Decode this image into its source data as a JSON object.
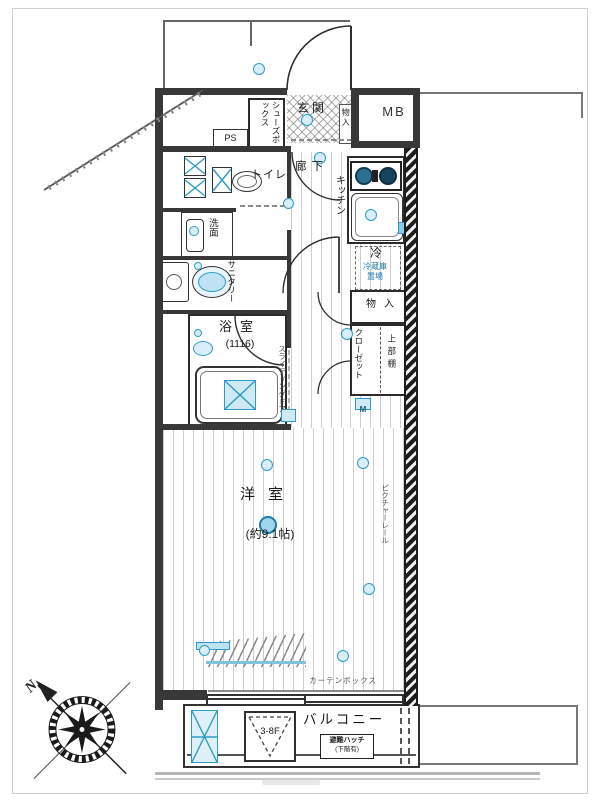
{
  "meta": {
    "accent_blue": "#2e9bc6",
    "fill_blue": "#d8eef8",
    "text_blue": "#1f78a8",
    "wall_color": "#383838"
  },
  "exterior": {
    "mb": "MB",
    "north": "N"
  },
  "entrance": {
    "genkan": "玄関",
    "shoes_box": "シューズボックス",
    "ps": "PS",
    "storage": "物入"
  },
  "water_area": {
    "toilet": "トイレ",
    "washroom": "洗面",
    "sanitary": "サニタリー",
    "bathroom": "浴室",
    "bathroom_size": "(1116)"
  },
  "kitchen_area": {
    "kitchen": "キッチン",
    "hallway": "廊下",
    "fridge": "冷",
    "fridge_space": "冷蔵庫置場"
  },
  "storage_area": {
    "storage": "物入",
    "closet": "クローゼット",
    "upper_shelf": "上部棚",
    "outlet_m": "M"
  },
  "living": {
    "name": "洋室",
    "size": "(約9.1帖)",
    "picture_rail": "ピクチャーレール",
    "sliding_door": "スライディングドア",
    "curtain_box": "カーテンボックス"
  },
  "balcony": {
    "name": "バルコニー",
    "floor_range": "3-8F",
    "hatch_line1": "避難ハッチ",
    "hatch_line2": "(下階有)"
  }
}
